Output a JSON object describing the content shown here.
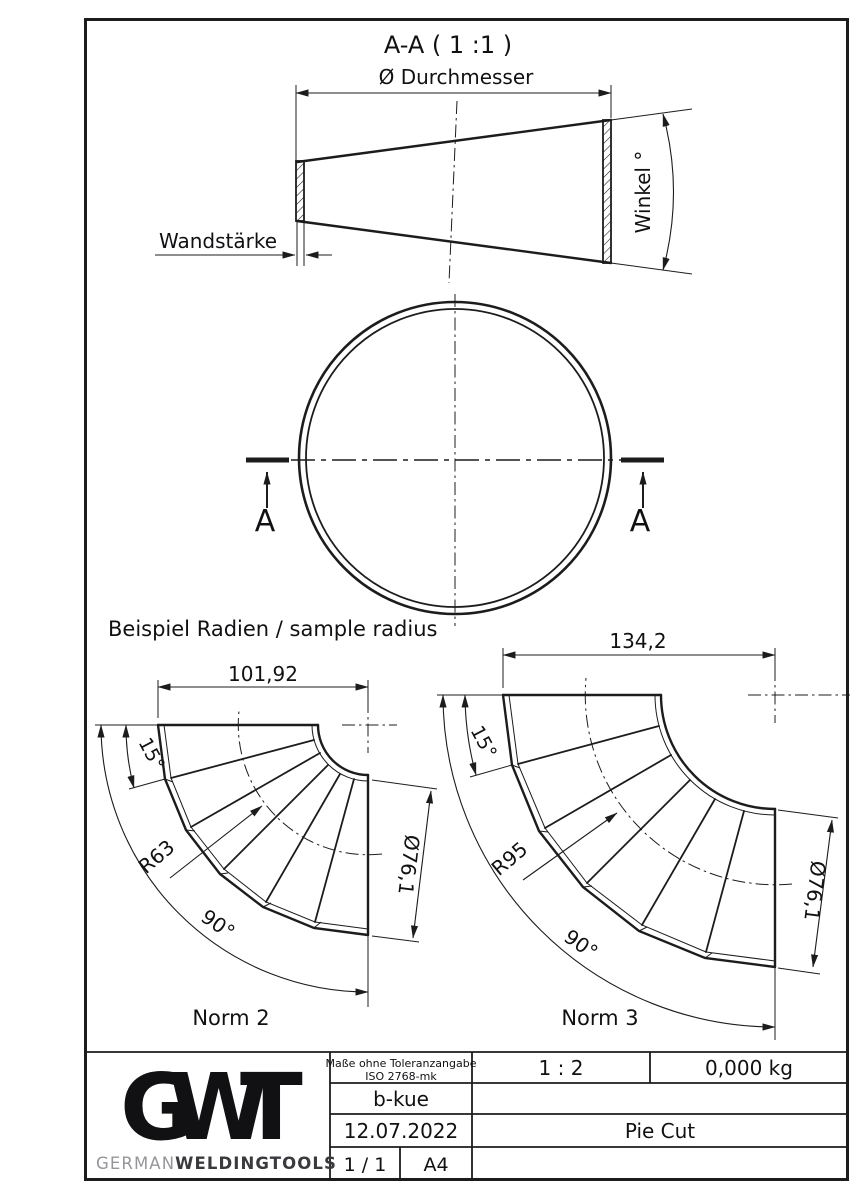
{
  "page": {
    "background": "#ffffff",
    "line_color": "#1c1c1c"
  },
  "section_view": {
    "title": "A-A ( 1 :1 )",
    "diameter_label": "Ø Durchmesser",
    "wall_label": "Wandstärke",
    "angle_label": "Winkel °"
  },
  "plan_view": {
    "section_marker": "A"
  },
  "examples": {
    "heading": "Beispiel Radien / sample radius",
    "norm2": {
      "name": "Norm 2",
      "width": "101,92",
      "segment_angle": "15°",
      "bend_radius": "R63",
      "total_angle": "90°",
      "diameter": "Ø76,1"
    },
    "norm3": {
      "name": "Norm 3",
      "width": "134,2",
      "segment_angle": "15°",
      "bend_radius": "R95",
      "total_angle": "90°",
      "diameter": "Ø76,1"
    }
  },
  "title_block": {
    "tolerance_line1": "Maße ohne Toleranzangabe",
    "tolerance_line2": "ISO 2768-mk",
    "scale": "1 : 2",
    "weight": "0,000 kg",
    "author": "b-kue",
    "date": "12.07.2022",
    "part_name": "Pie Cut",
    "sheet": "1 / 1",
    "format": "A4",
    "logo": {
      "letter_g": "G",
      "letter_w": "W",
      "letter_t": "T",
      "brand_light": "GERMAN",
      "brand_bold": "WELDINGTOOLS",
      "color_dark": "#35353e",
      "color_mid": "#565660",
      "color_gray": "#96969a"
    }
  }
}
